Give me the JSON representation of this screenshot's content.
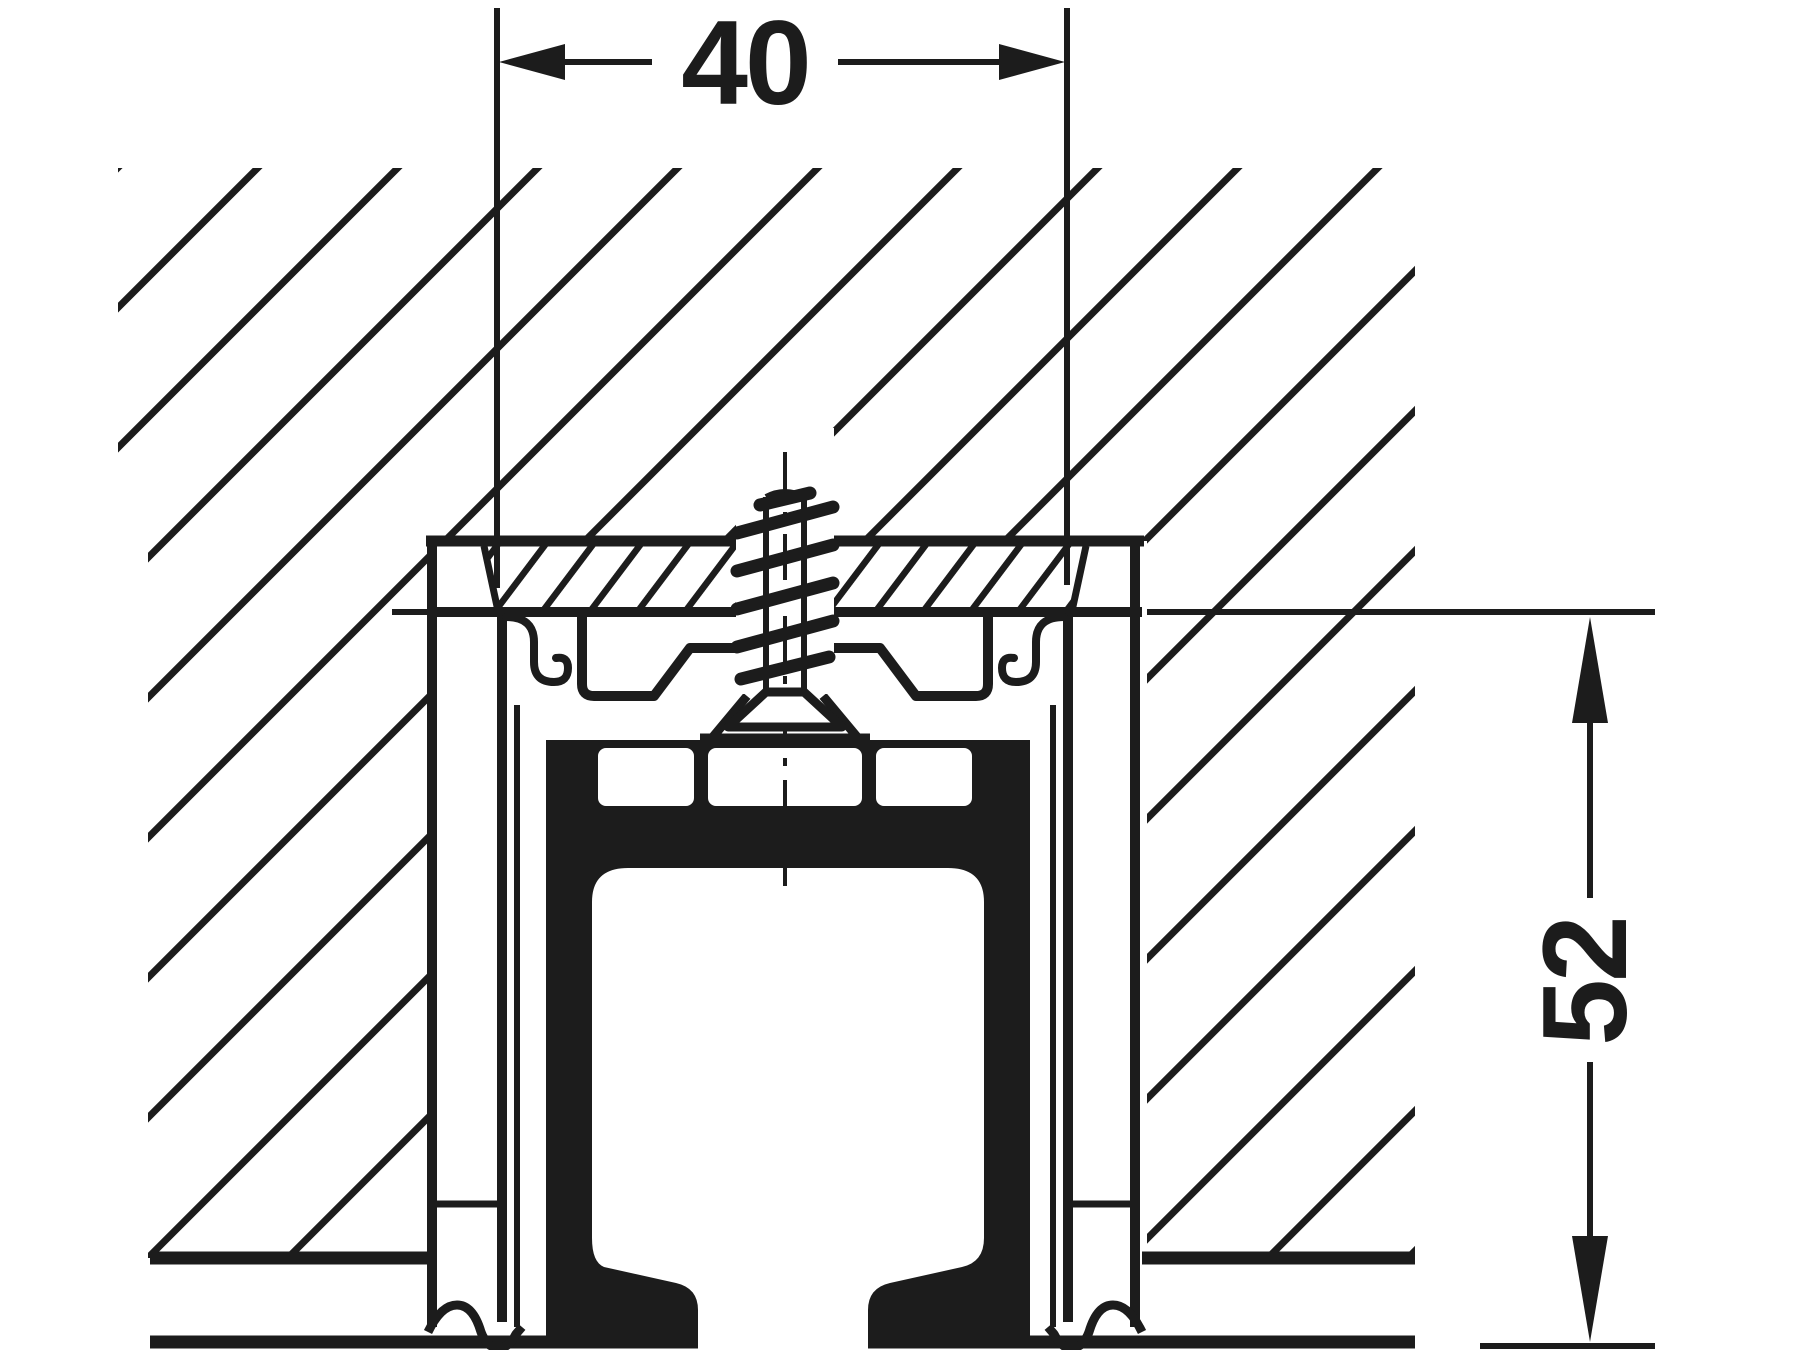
{
  "drawing": {
    "type": "technical-cross-section",
    "subject": "ceiling-mounted sliding door running track profile",
    "width_dimension": {
      "value": "40",
      "orientation": "horizontal",
      "position": "top"
    },
    "height_dimension": {
      "value": "52",
      "orientation": "vertical",
      "position": "right"
    },
    "colors": {
      "ink": "#1c1c1c",
      "background": "#ffffff"
    },
    "parts": {
      "wall_section": "hatched-wall-mass",
      "mounting_band": "hatched-mounting-board",
      "outer_profile": "aluminium-shell-outline",
      "inner_track": "solid-black-running-channel",
      "fastener": "mounting-screw-with-threads",
      "center_line": "screw-axis-dashed-centerline"
    }
  }
}
